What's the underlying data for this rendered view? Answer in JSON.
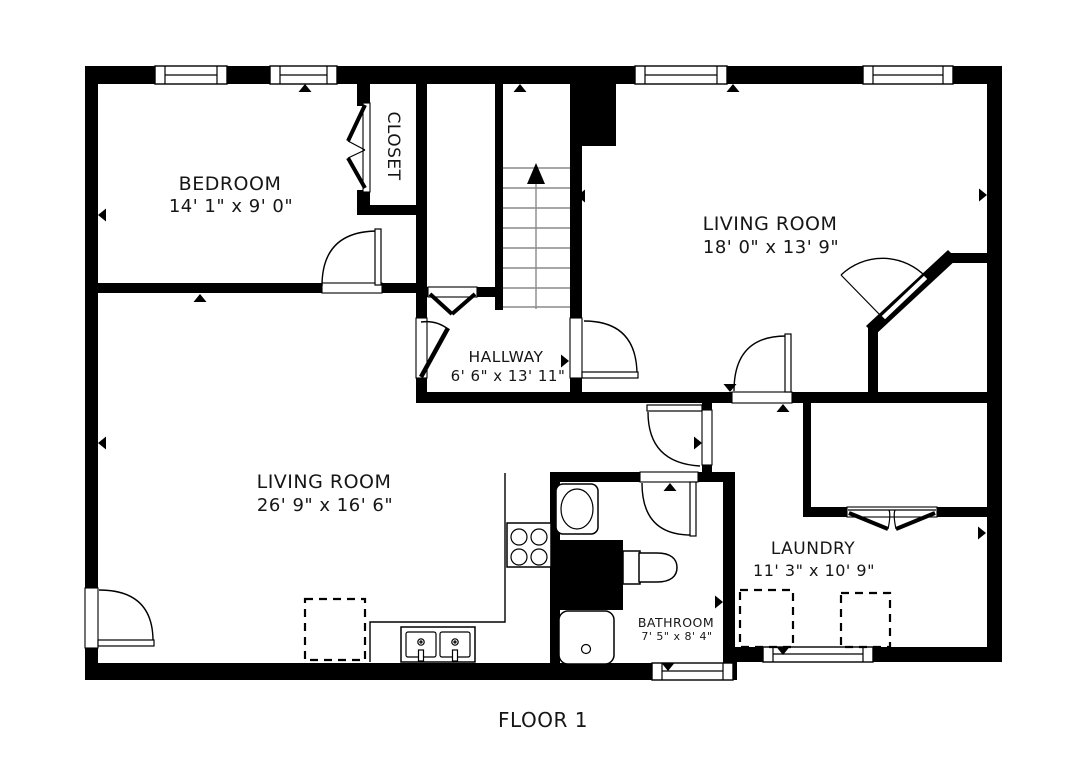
{
  "floor": {
    "caption": "FLOOR 1"
  },
  "rooms": {
    "bedroom": {
      "name": "BEDROOM",
      "dimensions": "14' 1\" x 9' 0\""
    },
    "closet": {
      "name": "CLOSET",
      "dimensions": ""
    },
    "living_room_top": {
      "name": "LIVING ROOM",
      "dimensions": "18' 0\" x 13' 9\""
    },
    "hallway": {
      "name": "HALLWAY",
      "dimensions": "6' 6\" x 13' 11\""
    },
    "living_room_bottom": {
      "name": "LIVING ROOM",
      "dimensions": "26' 9\" x 16' 6\""
    },
    "laundry": {
      "name": "LAUNDRY",
      "dimensions": "11' 3\" x 10' 9\""
    },
    "bathroom": {
      "name": "BATHROOM",
      "dimensions": "7' 5\" x 8' 4\""
    }
  },
  "stairs": {
    "direction": "up",
    "treads": 8
  },
  "fixtures": [
    "stove-icon",
    "kitchen-double-sink-icon",
    "bathroom-sink-icon",
    "toilet-icon",
    "shower-icon",
    "washer-dryer-dashed-placeholders",
    "appliance-dashed-placeholder"
  ],
  "windows_count": 6,
  "colors": {
    "wall": "#000000",
    "background": "#ffffff",
    "stair_tread": "#8a8a8a",
    "text": "#161616"
  }
}
